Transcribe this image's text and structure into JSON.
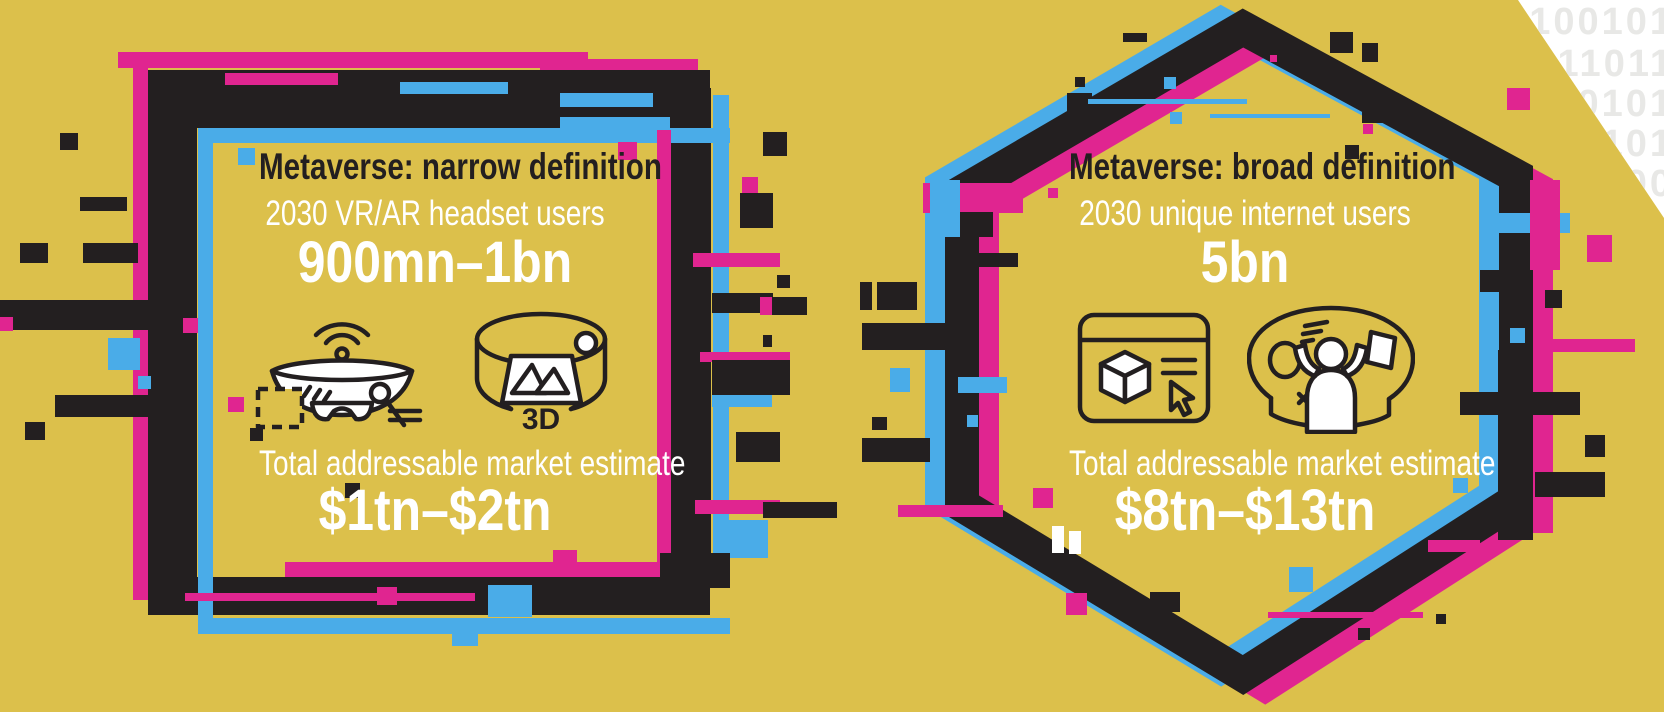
{
  "palette": {
    "background": "#DCC04B",
    "black": "#231F20",
    "magenta": "#E02590",
    "cyan": "#4AACE8",
    "white": "#FFFFFF",
    "binary_gray": "#E8E8E6"
  },
  "corner_binary": {
    "rows": [
      "0100101",
      "111011",
      "00101",
      "101",
      "00"
    ]
  },
  "panels": {
    "narrow": {
      "title": "Metaverse: narrow definition",
      "subtitle": "2030 VR/AR headset users",
      "users_value": "900mn–1bn",
      "market_label": "Total addressable market estimate",
      "market_value": "$1tn–$2tn",
      "icon_3d_label": "3D",
      "icons": [
        "vr-ar-headset-icon",
        "3d-environment-icon"
      ]
    },
    "broad": {
      "title": "Metaverse: broad definition",
      "subtitle": "2030 unique internet users",
      "users_value": "5bn",
      "market_label": "Total addressable market estimate",
      "market_value": "$8tn–$13tn",
      "icons": [
        "browser-3d-object-icon",
        "immersive-user-icon"
      ]
    }
  }
}
